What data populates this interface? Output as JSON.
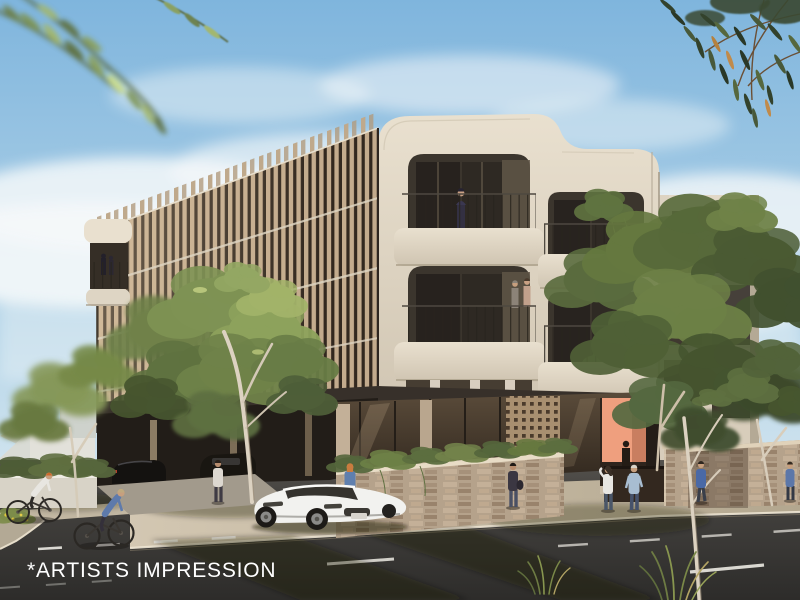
{
  "caption": {
    "text": "*ARTISTS IMPRESSION"
  },
  "alt_text": "Artist's impression render of a four-storey corner apartment building with vertical timber batten screens, cream curved balconies with planting, a stone podium and salmon entry, street trees, pedestrians, two cyclists and a white sports coupe on the street.",
  "palette": {
    "sky_top": "#7fb5dd",
    "sky_mid": "#b7d6e9",
    "sky_horizon": "#e6eff3",
    "cloud": "#f5f8f9",
    "cream": "#e9e0cf",
    "cream_shadow": "#cfc4b1",
    "batten": "#c3ab8d",
    "facade_dark": "#44382b",
    "canopy": "#37302a",
    "stone": "#b5a28b",
    "salmon": "#ef9f7e",
    "glass": "#3b352d",
    "road": "#454340",
    "road_dark": "#2d2c2a",
    "footpath": "#d3c7b2",
    "foliage_light": "#a2b369",
    "foliage": "#6f8249",
    "foliage_dark": "#47552f",
    "eucalyptus": "#3b4a31",
    "trunk": "#dcd2c1",
    "car": "#f2f2ef",
    "marking": "#eceae3"
  }
}
